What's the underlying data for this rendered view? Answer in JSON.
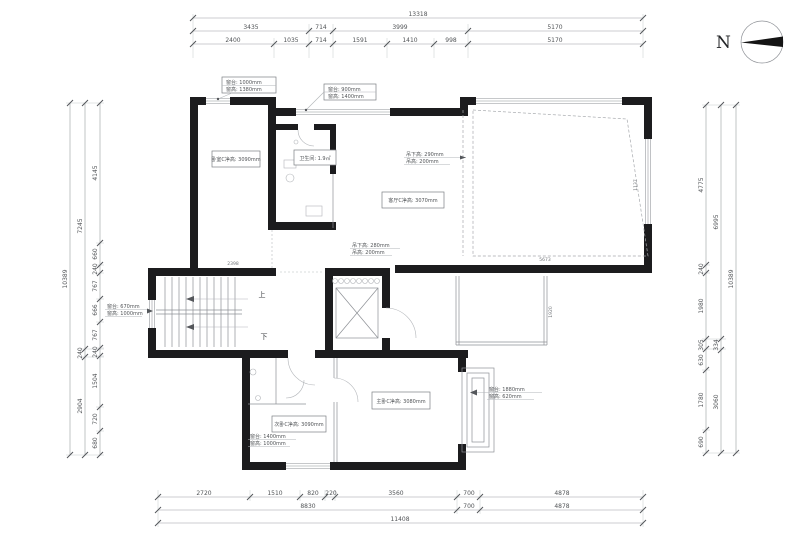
{
  "colors": {
    "wall": "#1c1c1e",
    "line": "#8e9196",
    "text": "#515457"
  },
  "north": {
    "label": "N"
  },
  "dims": {
    "top": {
      "total": "13318",
      "row2": [
        "3435",
        "714",
        "3999",
        "5170"
      ],
      "row3": [
        "2400",
        "1035",
        "714",
        "1591",
        "1410",
        "998",
        "5170"
      ]
    },
    "bottom": {
      "row1": [
        "2720",
        "1510",
        "820",
        "220",
        "3560",
        "700",
        "4878"
      ],
      "row2": [
        "8830",
        "700",
        "4878"
      ],
      "total": "11408"
    },
    "left": {
      "inner": [
        "4145",
        "660",
        "240",
        "767",
        "666",
        "767",
        "240",
        "1504",
        "720",
        "680"
      ],
      "middle": [
        "7245",
        "240",
        "2904"
      ],
      "outer": "10389"
    },
    "right": {
      "inner": [
        "4775",
        "240",
        "1980",
        "305",
        "630",
        "1780",
        "690"
      ],
      "middle": [
        "6995",
        "334",
        "3060"
      ],
      "outer": "10389"
    }
  },
  "interior_dims": {
    "bedroom_bottom": "2398",
    "living_bottom": "5673",
    "living_right": "1137",
    "balcony": "1920"
  },
  "rooms": {
    "bedroom_tl": "卧室C净高: 3090mm",
    "bath": "卫生间: 1.9㎡",
    "living": "客厅C净高: 3070mm",
    "bedroom_bl": "次卧C净高: 3090mm",
    "bedroom_br": "主卧C净高: 3080mm"
  },
  "annotations": {
    "win_tl": {
      "l1": "窗台: 1000mm",
      "l2": "窗高: 1380mm"
    },
    "win_tm": {
      "l1": "窗台: 900mm",
      "l2": "窗高: 1400mm"
    },
    "ceil_a": {
      "l1": "吊下高: 290mm",
      "l2": "吊高: 200mm"
    },
    "ceil_b": {
      "l1": "吊下高: 280mm",
      "l2": "吊高: 200mm"
    },
    "win_stair": {
      "l1": "窗台: 670mm",
      "l2": "窗高: 1000mm"
    },
    "win_bl": {
      "l1": "窗台: 1400mm",
      "l2": "窗高: 1000mm"
    },
    "win_br": {
      "l1": "窗台: 1880mm",
      "l2": "窗高: 620mm"
    }
  },
  "stairs": {
    "up": "上",
    "down": "下"
  }
}
